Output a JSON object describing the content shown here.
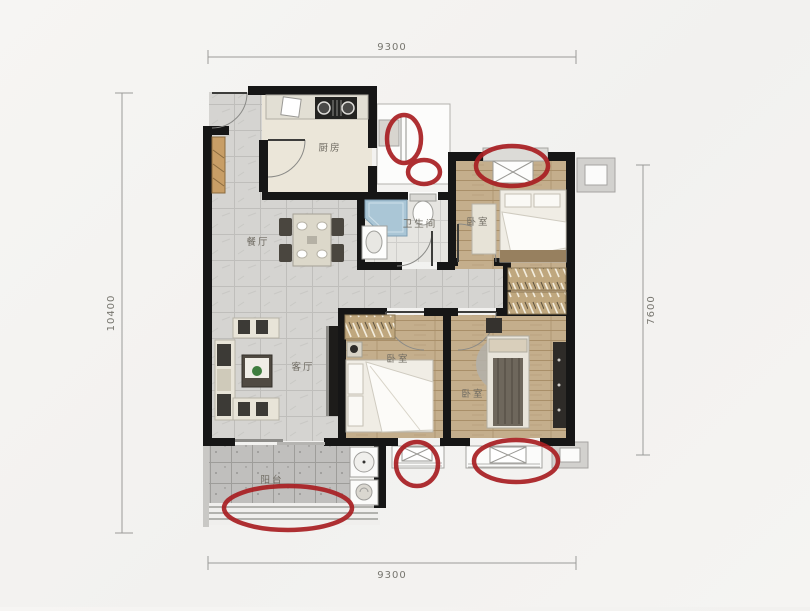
{
  "plan": {
    "type": "apartment-floor-plan",
    "background_color": "#f5f4f2",
    "wall_color": "#161616",
    "annotation_color": "#a81e22",
    "dimensions": {
      "top": "9300",
      "bottom": "9300",
      "left": "10400",
      "right": "7600"
    },
    "rooms": [
      {
        "key": "kitchen",
        "label": "厨房"
      },
      {
        "key": "bathroom",
        "label": "卫生间"
      },
      {
        "key": "bedroom_top_right",
        "label": "卧室"
      },
      {
        "key": "dining",
        "label": "餐厅"
      },
      {
        "key": "living",
        "label": "客厅"
      },
      {
        "key": "bedroom_middle",
        "label": "卧室"
      },
      {
        "key": "bedroom_bottom_right",
        "label": "卧室"
      },
      {
        "key": "balcony",
        "label": "阳台"
      }
    ],
    "annotations": {
      "shape": "red-ellipse",
      "count": 6,
      "targets": [
        "kitchen-side-window",
        "bathroom-window",
        "bedroom-top-right-window",
        "bedroom-middle-window",
        "bedroom-bottom-right-window",
        "balcony-window"
      ]
    }
  }
}
